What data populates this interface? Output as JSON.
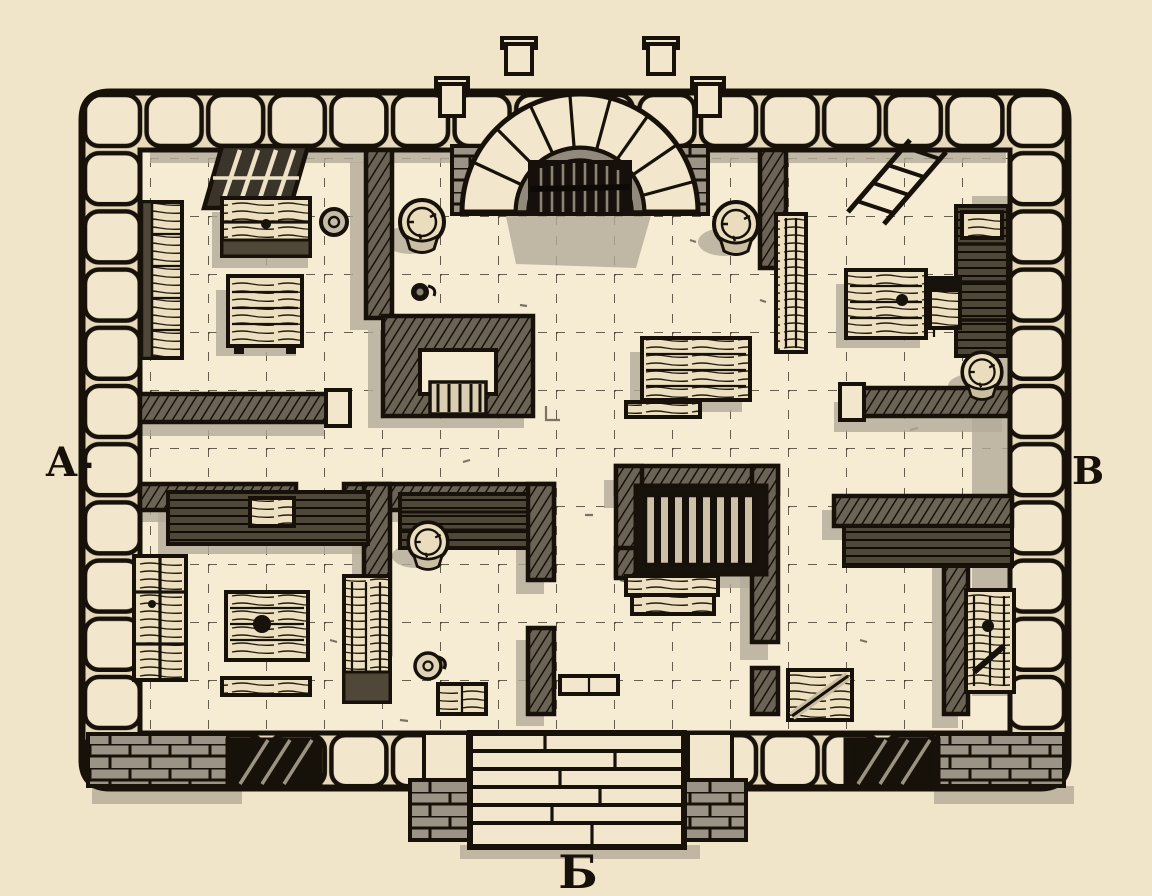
{
  "map": {
    "type": "hand-drawn dungeon floor plan",
    "style": "black ink on parchment, top-down plan with raised stone walls",
    "labels": {
      "left": "A-",
      "right": "B",
      "bottom": "Б"
    },
    "palette": {
      "parchment": "#f1e5c9",
      "floor": "#f6ecd4",
      "ink": "#17110a",
      "stone_gray": "#9b9486",
      "wall_hatch": "#6b6355",
      "soft_shadow": "#b4aa99",
      "wood_light": "#ece0c1",
      "wood_dark": "#4f4839"
    },
    "structures": {
      "north_gate": {
        "features": [
          "stone archway",
          "portcullis",
          "flanking merlons",
          "brick jambs"
        ]
      },
      "south_staircase": {
        "steps": 6,
        "flanked_by": "brick piers"
      },
      "outer_wall": {
        "style": "ring of large rounded stone blocks"
      },
      "floor_grid": {
        "style": "dashed square grid"
      },
      "bottom_windows": 2,
      "section_line": "A- to B"
    },
    "rooms": [
      {
        "name": "northwest-room",
        "furniture": [
          "barred window",
          "wooden chest",
          "clay pot",
          "bookshelf",
          "square table"
        ]
      },
      {
        "name": "north-hearth-nook",
        "furniture": [
          "barrel",
          "oil jug",
          "stone hearth with grate"
        ]
      },
      {
        "name": "great-hall",
        "furniture": [
          "barrel left of gate",
          "barrel right of gate",
          "long table",
          "bench",
          "small crate"
        ]
      },
      {
        "name": "northeast-room",
        "furniture": [
          "ladder on wall",
          "wall bench",
          "work table",
          "chair",
          "wall shelves",
          "barrel"
        ]
      },
      {
        "name": "southwest-room",
        "furniture": [
          "wall counter",
          "cabinet",
          "table with jug",
          "bench",
          "tall cabinet",
          "floor grate window"
        ]
      },
      {
        "name": "south-storage-room",
        "furniture": [
          "wall shelf",
          "barrel",
          "jug",
          "crate"
        ]
      },
      {
        "name": "south-bedroom",
        "furniture": [
          "slatted bed",
          "wooden step chest"
        ]
      },
      {
        "name": "southeast-room",
        "furniture": [
          "wall counter",
          "wooden door panel",
          "crate with plank",
          "floor grate window"
        ]
      }
    ]
  }
}
